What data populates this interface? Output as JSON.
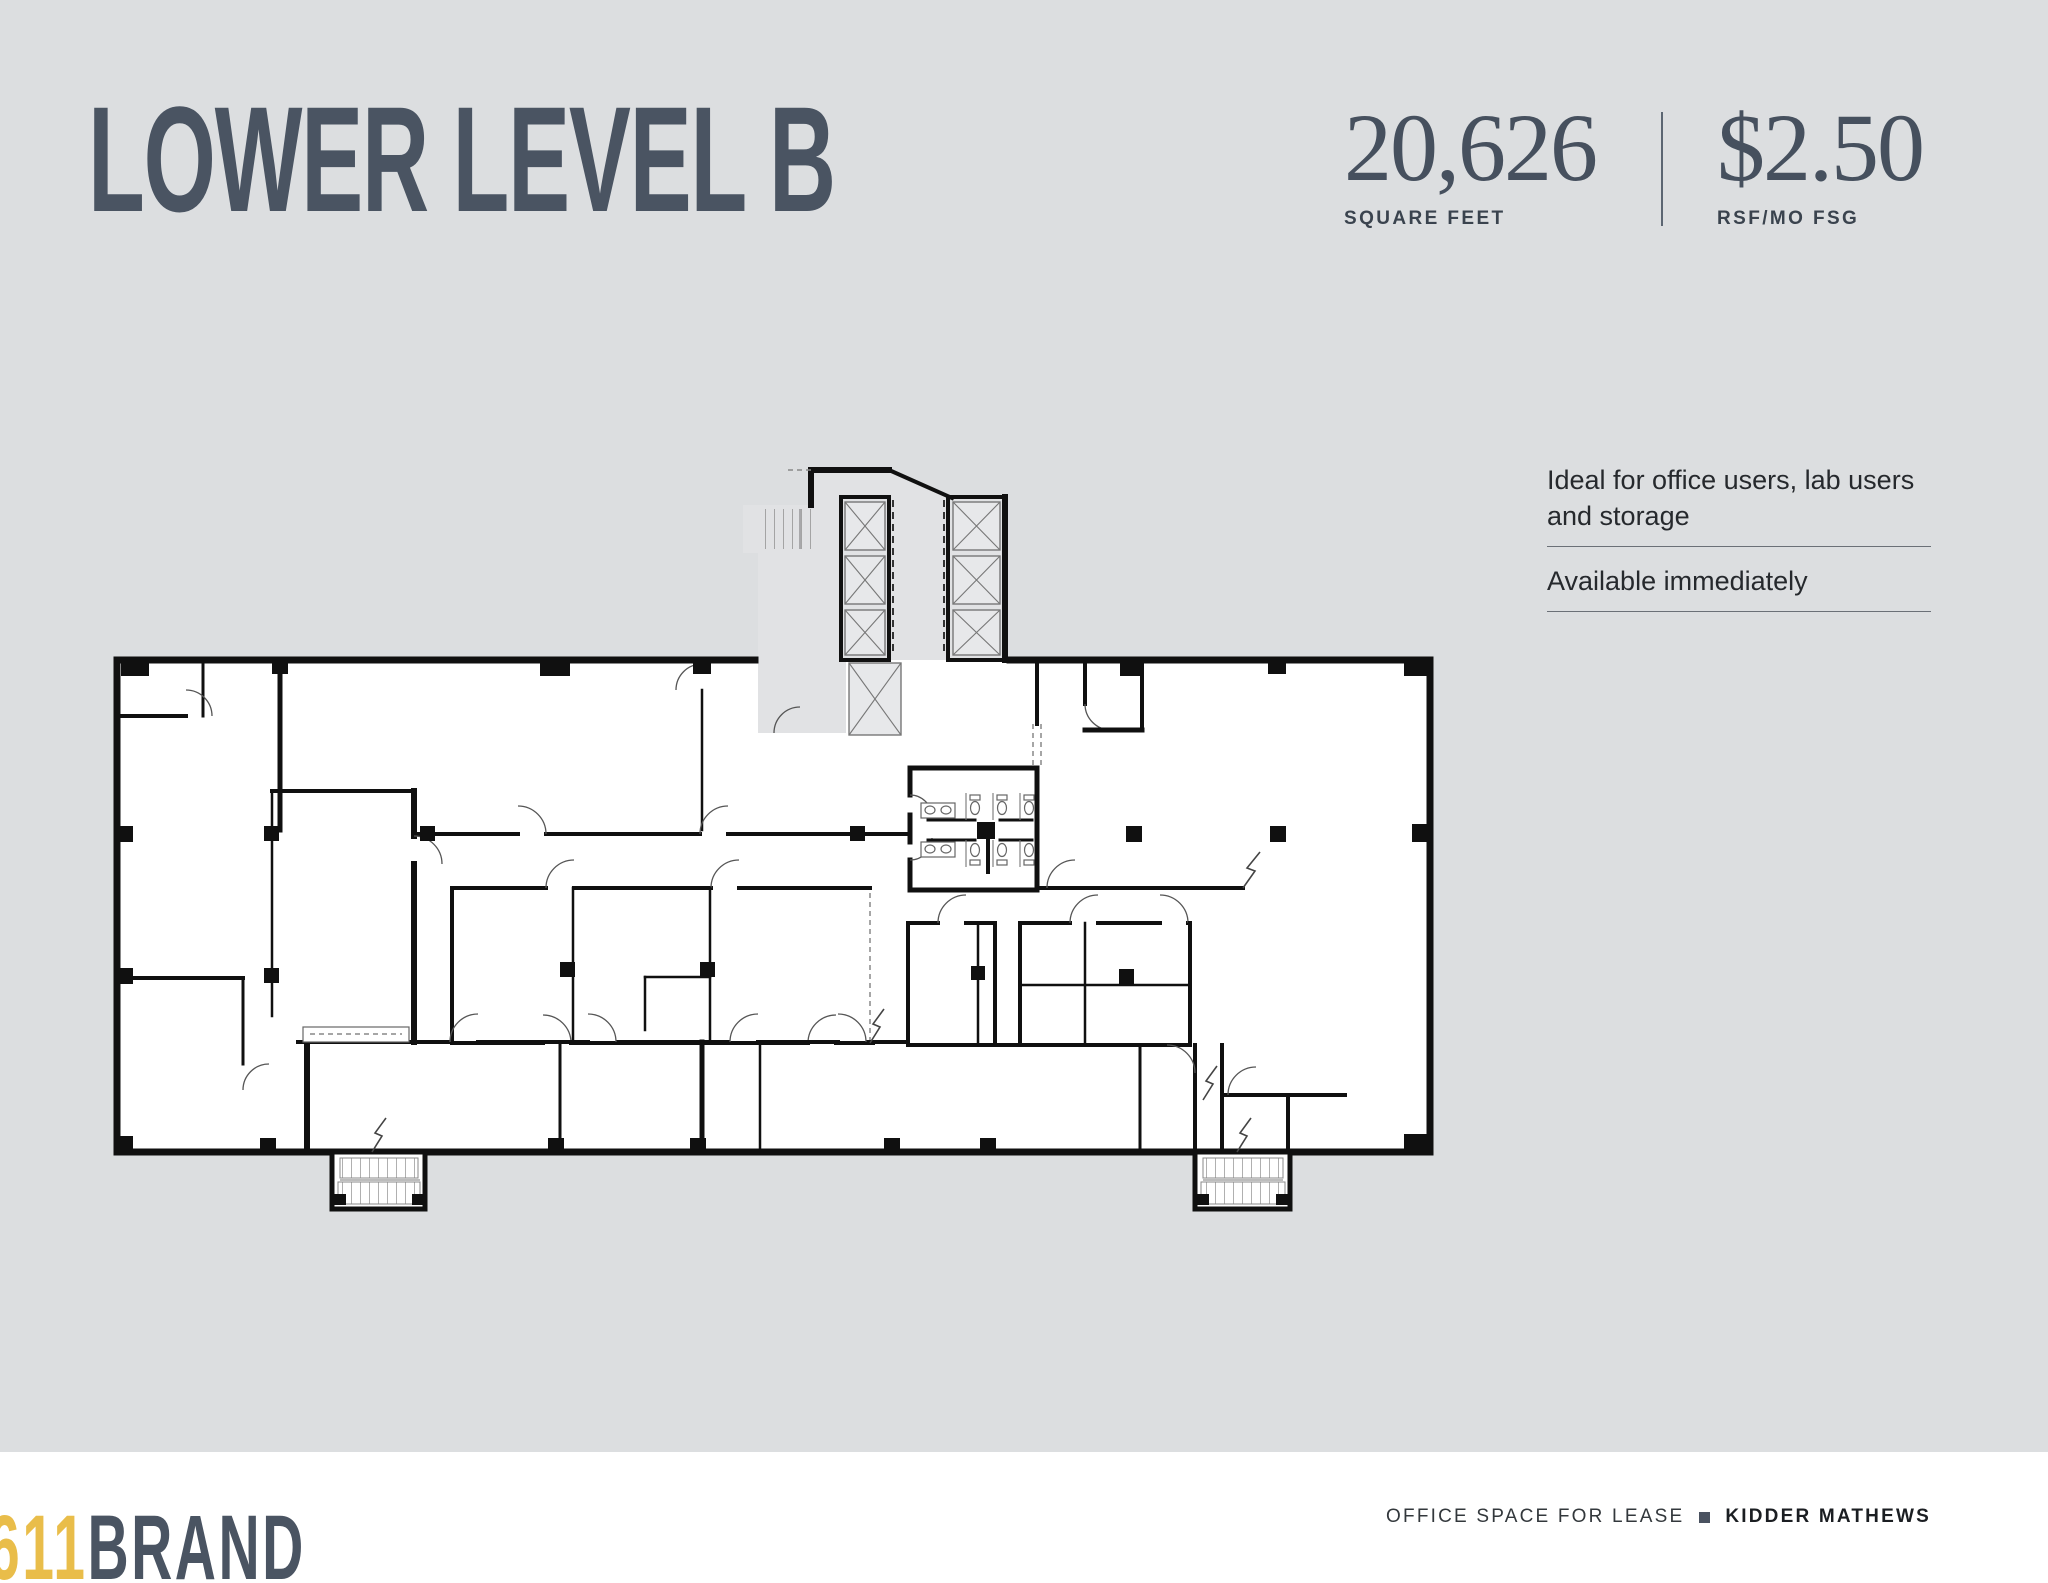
{
  "page": {
    "background_color": "#dcdee0",
    "footer_background": "#ffffff",
    "accent_yellow": "#e9bd4a",
    "slate": "#4a5462"
  },
  "header": {
    "title": "LOWER LEVEL B",
    "stats": [
      {
        "value": "20,626",
        "label": "SQUARE FEET"
      },
      {
        "value": "$2.50",
        "label": "RSF/MO FSG"
      }
    ]
  },
  "details": {
    "items": [
      {
        "lines": [
          "Ideal for office users, lab users",
          "and storage"
        ]
      },
      {
        "lines": [
          "Available immediately"
        ]
      }
    ]
  },
  "floor_plan": {
    "description": "Lower Level B architectural floor plan",
    "elevator_shafts": 7,
    "stairwells": 3,
    "restrooms": 2,
    "wall_color": "#101010",
    "floor_color": "#ffffff",
    "core_color": "#e1e2e4"
  },
  "footer": {
    "logo": {
      "prefix": "611",
      "suffix": "BRAND"
    },
    "lease_text": "OFFICE SPACE FOR LEASE",
    "broker": "KIDDER MATHEWS"
  }
}
